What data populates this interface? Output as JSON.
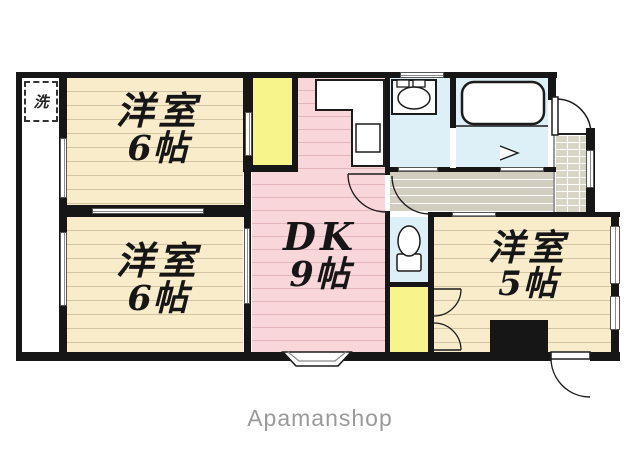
{
  "watermark": "Apamanshop",
  "plan": {
    "rooms": [
      {
        "key": "bedroom-upper-left",
        "line1": "洋室",
        "line2": "6帖"
      },
      {
        "key": "bedroom-lower-left",
        "line1": "洋室",
        "line2": "6帖"
      },
      {
        "key": "dining-kitchen",
        "line1": "DK",
        "line2": "9帖"
      },
      {
        "key": "bedroom-right",
        "line1": "洋室",
        "line2": "5帖"
      }
    ],
    "laundry_label": "洗"
  },
  "colors": {
    "room_fill": "#f8ecca",
    "dk_fill": "#f9d6da",
    "closet_fill": "#f7f48b",
    "wet_area_fill": "#ddeff7",
    "hallway_fill": "#d1cdbf",
    "entrance_fill": "#d8d4c6",
    "wall": "#161616",
    "watermark_text": "#9a9a9a"
  }
}
